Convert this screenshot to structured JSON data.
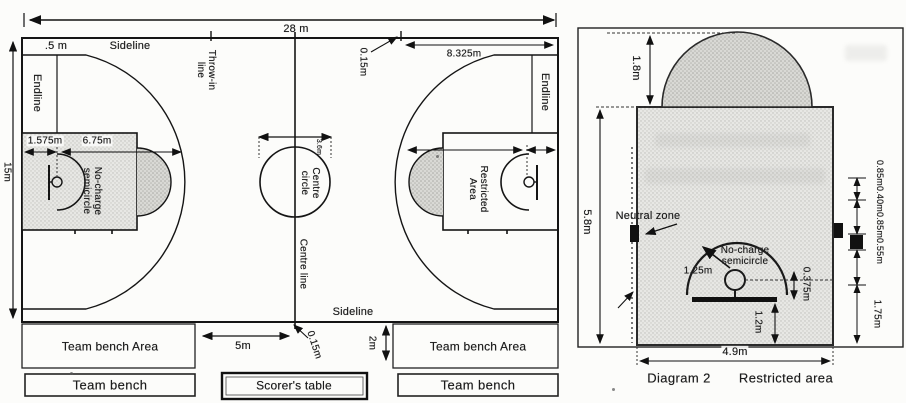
{
  "left_diagram": {
    "dims": {
      "length": "28 m",
      "width": "15m",
      "corner": ".5 m",
      "line_ext_top": "0.15m",
      "line_ext_bottom": "0.15m",
      "throw_in_dist": "8.325m",
      "backboard_offset": "1.575m",
      "three_point": "6.75m",
      "centre_dia": "3.6m",
      "bench_gap": "5m",
      "bench_depth": "2m"
    },
    "labels": {
      "sideline_top": "Sideline",
      "sideline_bottom": "Sideline",
      "endline_left": "Endline",
      "endline_right": "Endline",
      "throw_in": "Throw-in line",
      "centre_circle": "Centre circle",
      "centre_line": "Centre line",
      "no_charge": "No-charge semicircle",
      "restricted": "Restricted Area",
      "bench_area_left": "Team bench Area",
      "bench_area_right": "Team bench Area",
      "bench_left": "Team bench",
      "bench_right": "Team bench",
      "scorers_table": "Scorer's table"
    }
  },
  "right_diagram": {
    "dims": {
      "semicircle": "1.8m",
      "lane_length": "5.8m",
      "lane_width": "4.9m",
      "nc_radius": "1.25m",
      "ring_offset": "0.375m",
      "backboard_dist": "1.2m",
      "first_space": "1.75m",
      "spaces": "0.85m0.40m0.85m0.55m"
    },
    "labels": {
      "neutral_zone": "Neutral zone",
      "no_charge": "No-charge semicircle"
    },
    "caption": {
      "num": "Diagram 2",
      "title": "Restricted area"
    }
  }
}
